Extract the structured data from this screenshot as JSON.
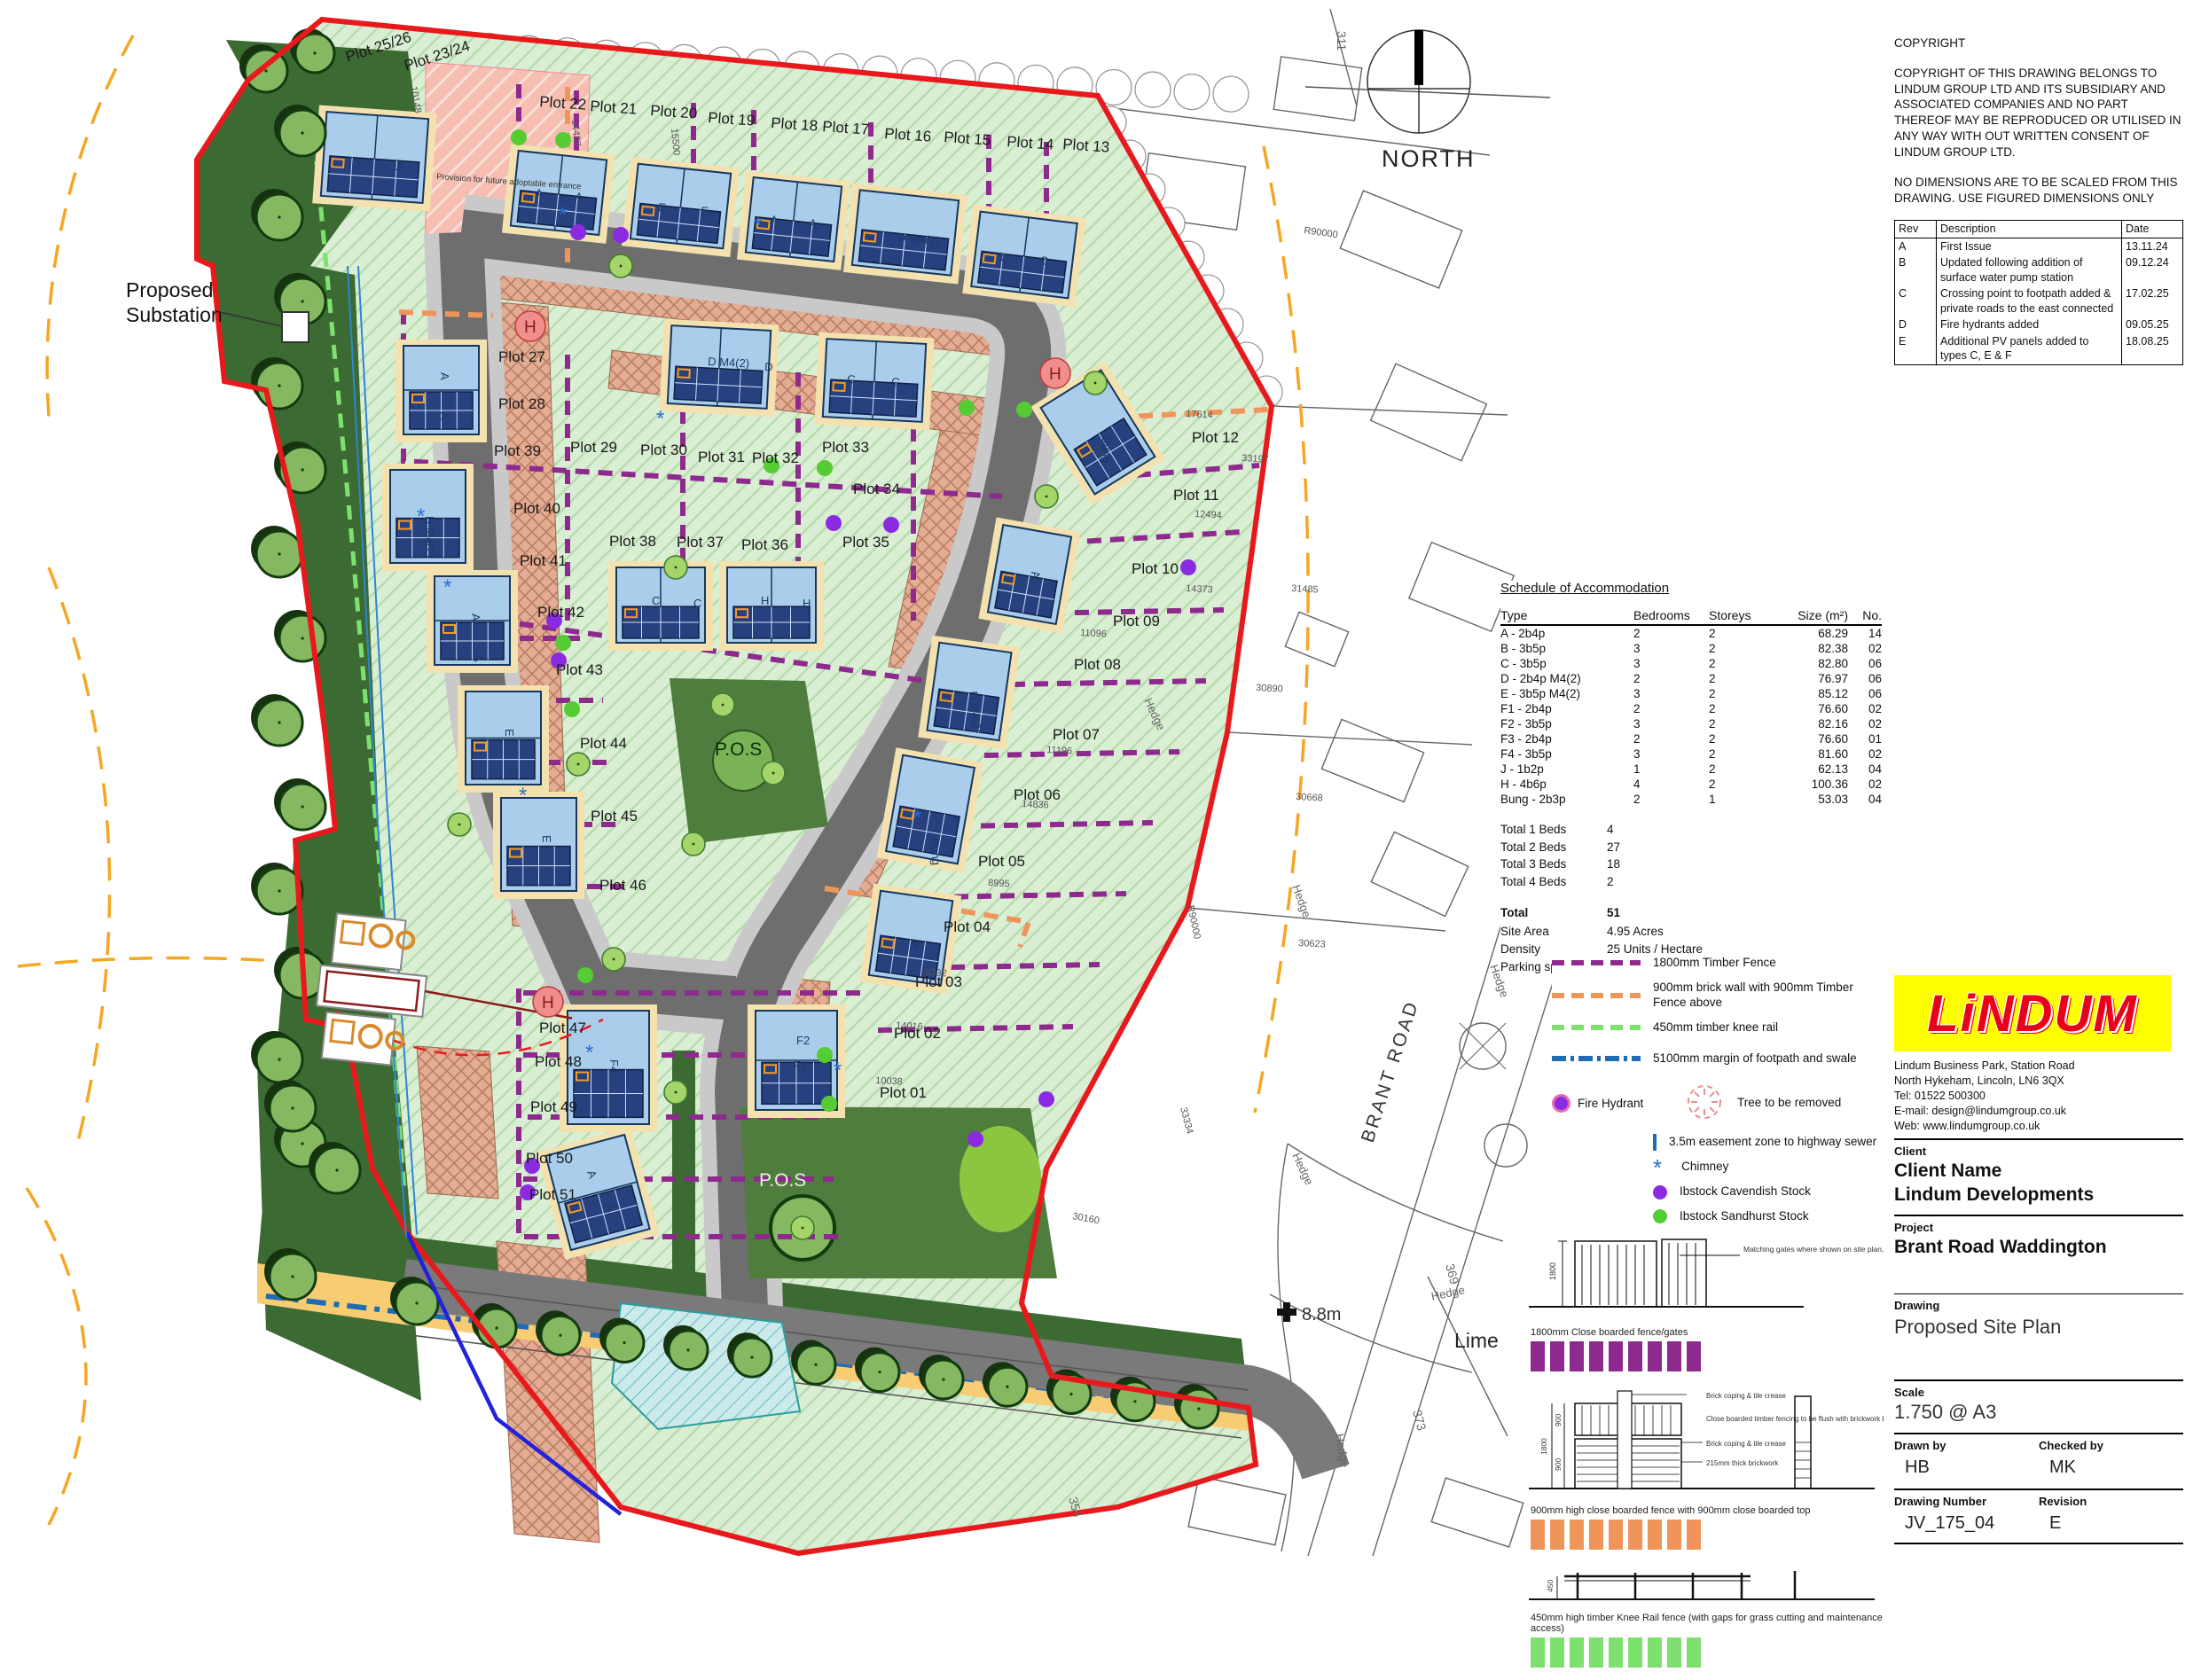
{
  "sheet": {
    "north_label": "NORTH",
    "substation_label": "Proposed\nSubstation"
  },
  "copyright": {
    "title": "COPYRIGHT",
    "body": "COPYRIGHT OF THIS DRAWING BELONGS TO LINDUM GROUP LTD AND ITS SUBSIDIARY AND ASSOCIATED COMPANIES AND NO PART THEREOF MAY BE REPRODUCED OR UTILISED IN ANY WAY WITH OUT WRITTEN CONSENT OF LINDUM GROUP LTD.",
    "note": "NO DIMENSIONS ARE TO BE SCALED FROM THIS DRAWING. USE FIGURED DIMENSIONS ONLY"
  },
  "revisions": {
    "headers": [
      "Rev",
      "Description",
      "Date"
    ],
    "rows": [
      [
        "A",
        "First Issue",
        "13.11.24"
      ],
      [
        "B",
        "Updated following addition of surface water pump station",
        "09.12.24"
      ],
      [
        "C",
        "Crossing point to footpath added & private roads to the east connected",
        "17.02.25"
      ],
      [
        "D",
        "Fire hydrants added",
        "09.05.25"
      ],
      [
        "E",
        "Additional PV panels added to types C, E & F",
        "18.08.25"
      ]
    ]
  },
  "schedule": {
    "title": "Schedule of Accommodation",
    "headers": [
      "Type",
      "Bedrooms",
      "Storeys",
      "Size (m²)",
      "No."
    ],
    "rows": [
      [
        "A - 2b4p",
        "2",
        "2",
        "68.29",
        "14"
      ],
      [
        "B - 3b5p",
        "3",
        "2",
        "82.38",
        "02"
      ],
      [
        "C - 3b5p",
        "3",
        "2",
        "82.80",
        "06"
      ],
      [
        "D - 2b4p M4(2)",
        "2",
        "2",
        "76.97",
        "06"
      ],
      [
        "E - 3b5p M4(2)",
        "3",
        "2",
        "85.12",
        "06"
      ],
      [
        "F1 -  2b4p",
        "2",
        "2",
        "76.60",
        "02"
      ],
      [
        "F2 - 3b5p",
        "3",
        "2",
        "82.16",
        "02"
      ],
      [
        "F3 - 2b4p",
        "2",
        "2",
        "76.60",
        "01"
      ],
      [
        "F4 - 3b5p",
        "3",
        "2",
        "81.60",
        "02"
      ],
      [
        "J -  1b2p",
        "1",
        "2",
        "62.13",
        "04"
      ],
      [
        "H - 4b6p",
        "4",
        "2",
        "100.36",
        "02"
      ],
      [
        "Bung - 2b3p",
        "2",
        "1",
        "53.03",
        "04"
      ]
    ],
    "totals": [
      [
        "Total 1 Beds",
        "4"
      ],
      [
        "Total 2 Beds",
        "27"
      ],
      [
        "Total 3 Beds",
        "18"
      ],
      [
        "Total 4 Beds",
        "2"
      ]
    ],
    "stats": {
      "total_label": "Total",
      "total": "51",
      "site_area_label": "Site Area",
      "site_area": "4.95 Acres",
      "density_label": "Density",
      "density": "25 Units / Hectare",
      "parking_label": "Parking spaces",
      "parking": "98"
    }
  },
  "legend": {
    "fence_purple": "1800mm Timber Fence",
    "fence_orange": "900mm brick wall with 900mm Timber Fence above",
    "fence_green": "450mm timber knee rail",
    "margin_blue": "5100mm margin of footpath and swale",
    "fire_hydrant": "Fire Hydrant",
    "tree_removed": "Tree to be removed",
    "easement": "3.5m easement zone to highway sewer",
    "chimney": "Chimney",
    "brick_cavendish": "Ibstock Cavendish Stock",
    "brick_sandhurst": "Ibstock Sandhurst Stock",
    "grass_verge": "Adoptable grass verge / filter trench",
    "colors": {
      "purple": "#8e2a8e",
      "orange": "#f0955a",
      "green": "#7ee06e",
      "blue": "#1f6cb4",
      "hydrant": "#e86ab4",
      "cavendish": "#8a2be2",
      "sandhurst": "#55cc33",
      "easement_fill": "#f8cc73",
      "boundary_red": "#e8191c"
    }
  },
  "fence_details": {
    "d1_caption": "1800mm Close boarded fence/gates",
    "d1_dim": "1800",
    "d1_note": "Matching gates where shown on site plan, to include lock",
    "d2_caption": "900mm high close boarded fence with 900mm close boarded top",
    "d2_dims": [
      "1800",
      "900",
      "900"
    ],
    "d2_note1": "Brick coping & tile crease",
    "d2_note2": "Close boarded timber fencing to be flush with brickwork below to prevent climbing",
    "d2_note3": "Brick coping & tile crease",
    "d2_note4": "215mm thick brickwork",
    "d3_caption": "450mm high timber Knee Rail fence (with gaps for grass cutting and maintenance access)",
    "d3_dim": "450"
  },
  "title_block": {
    "logo_text": "LiNDUM",
    "address": "Lindum Business Park, Station Road\nNorth Hykeham, Lincoln, LN6 3QX\nTel: 01522 500300\nE-mail: design@lindumgroup.co.uk\nWeb: www.lindumgroup.co.uk",
    "client_label": "Client",
    "client_name": "Client Name",
    "client_company": "Lindum Developments",
    "project_label": "Project",
    "project": "Brant Road Waddington",
    "drawing_label": "Drawing",
    "drawing": "Proposed Site Plan",
    "scale_label": "Scale",
    "scale": "1.750 @ A3",
    "drawn_label": "Drawn by",
    "drawn": "HB",
    "checked_label": "Checked by",
    "checked": "MK",
    "number_label": "Drawing Number",
    "number": "JV_175_04",
    "revision_label": "Revision",
    "revision": "E"
  },
  "plan": {
    "pos_label_1": "P.O.S",
    "pos_label_2": "P.O.S",
    "brant_road": "BRANT ROAD",
    "benchmark": "8.8m",
    "lime": "Lime",
    "future_entrance": "Provision for future adoptable entrance",
    "plot_labels": [
      [
        "Plot 25/26",
        392,
        70,
        -18
      ],
      [
        "Plot 23/24",
        458,
        80,
        -18
      ],
      [
        "Plot 22",
        608,
        120,
        4
      ],
      [
        "Plot 21",
        665,
        125,
        4
      ],
      [
        "Plot 20",
        733,
        130,
        4
      ],
      [
        "Plot 19",
        798,
        138,
        4
      ],
      [
        "Plot 18",
        869,
        144,
        4
      ],
      [
        "Plot 17",
        927,
        148,
        4
      ],
      [
        "Plot 16",
        997,
        156,
        4
      ],
      [
        "Plot 15",
        1064,
        160,
        4
      ],
      [
        "Plot 14",
        1135,
        165,
        4
      ],
      [
        "Plot 13",
        1198,
        168,
        4
      ],
      [
        "Plot 27",
        562,
        408,
        0
      ],
      [
        "Plot 28",
        562,
        461,
        0
      ],
      [
        "Plot 29",
        643,
        510,
        0
      ],
      [
        "Plot 30",
        722,
        513,
        0
      ],
      [
        "Plot 31",
        787,
        521,
        0
      ],
      [
        "Plot 32",
        848,
        522,
        0
      ],
      [
        "Plot 33",
        927,
        510,
        0
      ],
      [
        "Plot 34",
        962,
        557,
        0
      ],
      [
        "Plot 12",
        1344,
        499,
        0
      ],
      [
        "Plot 11",
        1323,
        564,
        0
      ],
      [
        "Plot 39",
        557,
        514,
        0
      ],
      [
        "Plot 40",
        579,
        579,
        0
      ],
      [
        "Plot 41",
        586,
        638,
        0
      ],
      [
        "Plot 38",
        687,
        616,
        0
      ],
      [
        "Plot 37",
        763,
        617,
        0
      ],
      [
        "Plot 36",
        836,
        620,
        0
      ],
      [
        "Plot 35",
        950,
        617,
        0
      ],
      [
        "Plot 10",
        1276,
        647,
        0
      ],
      [
        "Plot 42",
        606,
        696,
        0
      ],
      [
        "Plot 09",
        1255,
        706,
        0
      ],
      [
        "Plot 08",
        1211,
        755,
        0
      ],
      [
        "Plot 43",
        627,
        761,
        0
      ],
      [
        "Plot 07",
        1187,
        834,
        0
      ],
      [
        "Plot 44",
        654,
        844,
        0
      ],
      [
        "Plot 06",
        1143,
        902,
        0
      ],
      [
        "Plot 45",
        666,
        926,
        0
      ],
      [
        "Plot 05",
        1103,
        977,
        0
      ],
      [
        "Plot 46",
        676,
        1004,
        0
      ],
      [
        "Plot 04",
        1064,
        1051,
        0
      ],
      [
        "Plot 03",
        1032,
        1113,
        0
      ],
      [
        "Plot 47",
        608,
        1165,
        0
      ],
      [
        "Plot 02",
        1008,
        1171,
        0
      ],
      [
        "Plot 48",
        603,
        1203,
        0
      ],
      [
        "Plot 01",
        992,
        1238,
        0
      ],
      [
        "Plot 49",
        598,
        1254,
        0
      ],
      [
        "Plot 50",
        593,
        1312,
        0
      ],
      [
        "Plot 51",
        597,
        1353,
        0
      ]
    ],
    "house_letters": [
      [
        "J",
        400,
        190,
        0
      ],
      [
        "J",
        446,
        193,
        0
      ],
      [
        "A",
        603,
        222,
        5
      ],
      [
        "A",
        648,
        226,
        5
      ],
      [
        "E",
        742,
        238,
        5
      ],
      [
        "E",
        790,
        242,
        5
      ],
      [
        "A",
        868,
        252,
        5
      ],
      [
        "A",
        912,
        256,
        5
      ],
      [
        "D M4(2)",
        1012,
        272,
        5
      ],
      [
        "C",
        1128,
        295,
        5
      ],
      [
        "C",
        1172,
        298,
        5
      ],
      [
        "A",
        497,
        420,
        90
      ],
      [
        "A",
        497,
        465,
        90
      ],
      [
        "D M4(2)",
        798,
        412,
        3
      ],
      [
        "D",
        862,
        418,
        3
      ],
      [
        "C",
        955,
        432,
        3
      ],
      [
        "C",
        1005,
        435,
        3
      ],
      [
        "Bung",
        1243,
        492,
        90
      ],
      [
        "A",
        1163,
        645,
        80
      ],
      [
        "D M4(2)",
        1093,
        780,
        85
      ],
      [
        "C",
        735,
        682,
        0
      ],
      [
        "C",
        782,
        685,
        0
      ],
      [
        "H",
        858,
        682,
        0
      ],
      [
        "H",
        905,
        685,
        0
      ],
      [
        "D M4(2)",
        480,
        582,
        90
      ],
      [
        "A",
        532,
        692,
        90
      ],
      [
        "A",
        535,
        738,
        90
      ],
      [
        "E",
        570,
        822,
        90
      ],
      [
        "E",
        574,
        868,
        90
      ],
      [
        "E",
        612,
        942,
        90
      ],
      [
        "F4",
        688,
        1195,
        90
      ],
      [
        "A",
        662,
        1322,
        70
      ],
      [
        "A",
        683,
        1360,
        70
      ],
      [
        "F2",
        898,
        1178,
        0
      ],
      [
        "F1",
        895,
        1206,
        0
      ],
      [
        "Bung",
        1049,
        946,
        85
      ],
      [
        "A",
        1028,
        1062,
        75
      ]
    ],
    "dim_labels": [
      [
        "R90000",
        1470,
        263,
        8
      ],
      [
        "17614",
        1337,
        470,
        3
      ],
      [
        "33197",
        1400,
        520,
        3
      ],
      [
        "12494",
        1347,
        583,
        3
      ],
      [
        "14373",
        1337,
        667,
        3
      ],
      [
        "31485",
        1456,
        667,
        3
      ],
      [
        "11096",
        1218,
        717,
        3
      ],
      [
        "30890",
        1416,
        779,
        3
      ],
      [
        "11196",
        1180,
        849,
        3
      ],
      [
        "14836",
        1152,
        910,
        3
      ],
      [
        "30668",
        1461,
        902,
        3
      ],
      [
        "8995",
        1114,
        999,
        3
      ],
      [
        "R90000",
        1339,
        1022,
        78
      ],
      [
        "30623",
        1464,
        1067,
        3
      ],
      [
        "9332",
        1043,
        1100,
        3
      ],
      [
        "14016",
        1010,
        1160,
        3
      ],
      [
        "10038",
        987,
        1222,
        3
      ],
      [
        "33334",
        1331,
        1250,
        75
      ],
      [
        "30160",
        1209,
        1375,
        10
      ],
      [
        "10148",
        463,
        98,
        80
      ],
      [
        "14437",
        645,
        135,
        85
      ],
      [
        "15500",
        757,
        145,
        85
      ]
    ],
    "os_numbers": [
      [
        "311",
        1508,
        35,
        90
      ],
      [
        "330",
        1934,
        690,
        90
      ],
      [
        "340",
        1938,
        1040,
        90
      ],
      [
        "350",
        1928,
        1290,
        75
      ],
      [
        "369",
        1630,
        1427,
        75
      ],
      [
        "373",
        1593,
        1592,
        75
      ],
      [
        "354",
        1205,
        1690,
        75
      ]
    ],
    "hedge_labels": [
      [
        "Hedge",
        1290,
        790,
        65
      ],
      [
        "Hedge",
        1457,
        1000,
        70
      ],
      [
        "Hedge",
        1457,
        1303,
        65
      ],
      [
        "Hedge",
        1506,
        1618,
        80
      ],
      [
        "Hedge",
        1615,
        1467,
        -12
      ],
      [
        "Hedge",
        1680,
        1090,
        70
      ]
    ],
    "hydrant_letter": "H"
  }
}
